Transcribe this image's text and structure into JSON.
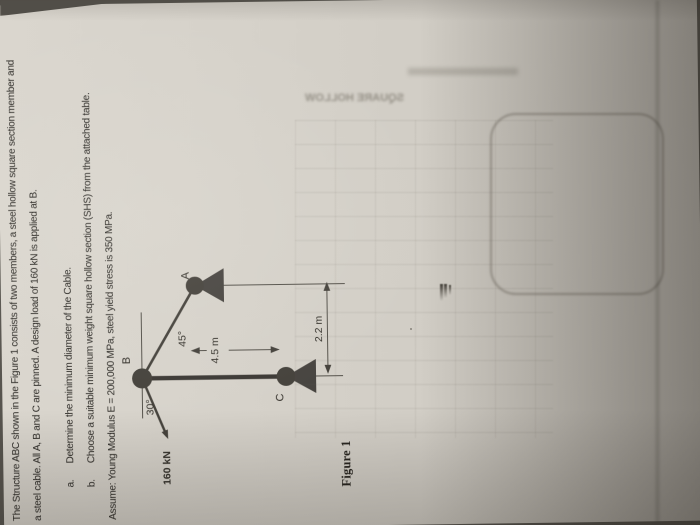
{
  "doc": {
    "line1": "The Structure ABC shown in the Figure 1 consists of two members, a steel hollow square section member and",
    "line2": "a steel cable.  All A, B and C are pinned. A design load of 160 kN is applied at B.",
    "item_a_marker": "a.",
    "item_a": "Determine the minimum diameter of the Cable.",
    "item_b_marker": "b.",
    "item_b": "Choose a suitable minimum weight square hollow section (SHS) from the attached table.",
    "assumption": "Assume: Young Modulus E = 200,000 MPa, steel yield stress is 350 MPa.",
    "caption": "Figure 1"
  },
  "figure": {
    "joint_a": "A",
    "joint_b": "B",
    "joint_c": "C",
    "cable_angle": "45°",
    "load_angle": "30°",
    "dim_bc": "4.5 m",
    "dim_ca": "2.2 m",
    "load": "160 kN"
  },
  "showthrough": {
    "mirrored_text": "SQUARE HOLLOW"
  },
  "colors": {
    "paper": "#d6d2ca",
    "ink": "#2b2925",
    "figure_ink": "#45423c",
    "background": "#57544e"
  }
}
